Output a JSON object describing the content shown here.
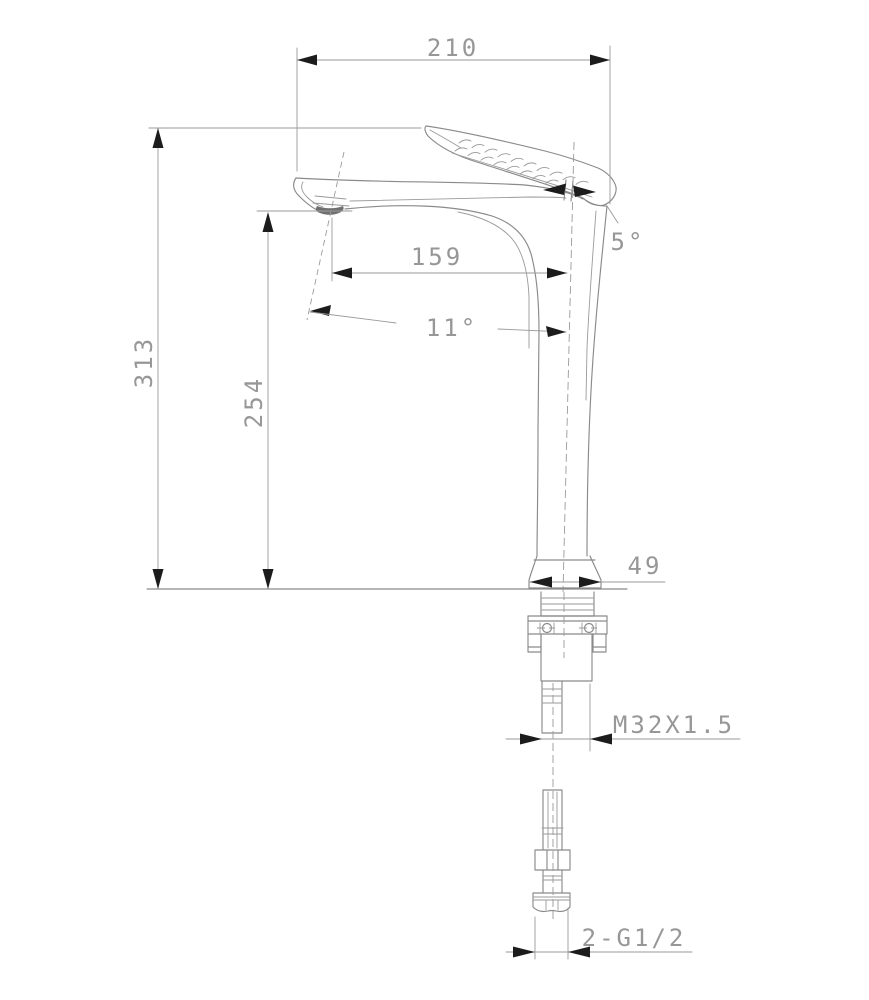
{
  "page": {
    "background": "#ffffff"
  },
  "drawing": {
    "colors": {
      "line": "#8a8a8a",
      "arrow": "#1c1c1c",
      "text": "#979797",
      "aerator_fill": "#707070",
      "background": "#ffffff"
    },
    "labels": {
      "overall_width": "210",
      "overall_height": "313",
      "spout_height": "254",
      "spout_reach": "159",
      "body_angle": "5°",
      "stream_angle": "11°",
      "base_width": "49",
      "mount_thread": "M32X1.5",
      "hose_connection": "2-G1/2"
    }
  }
}
